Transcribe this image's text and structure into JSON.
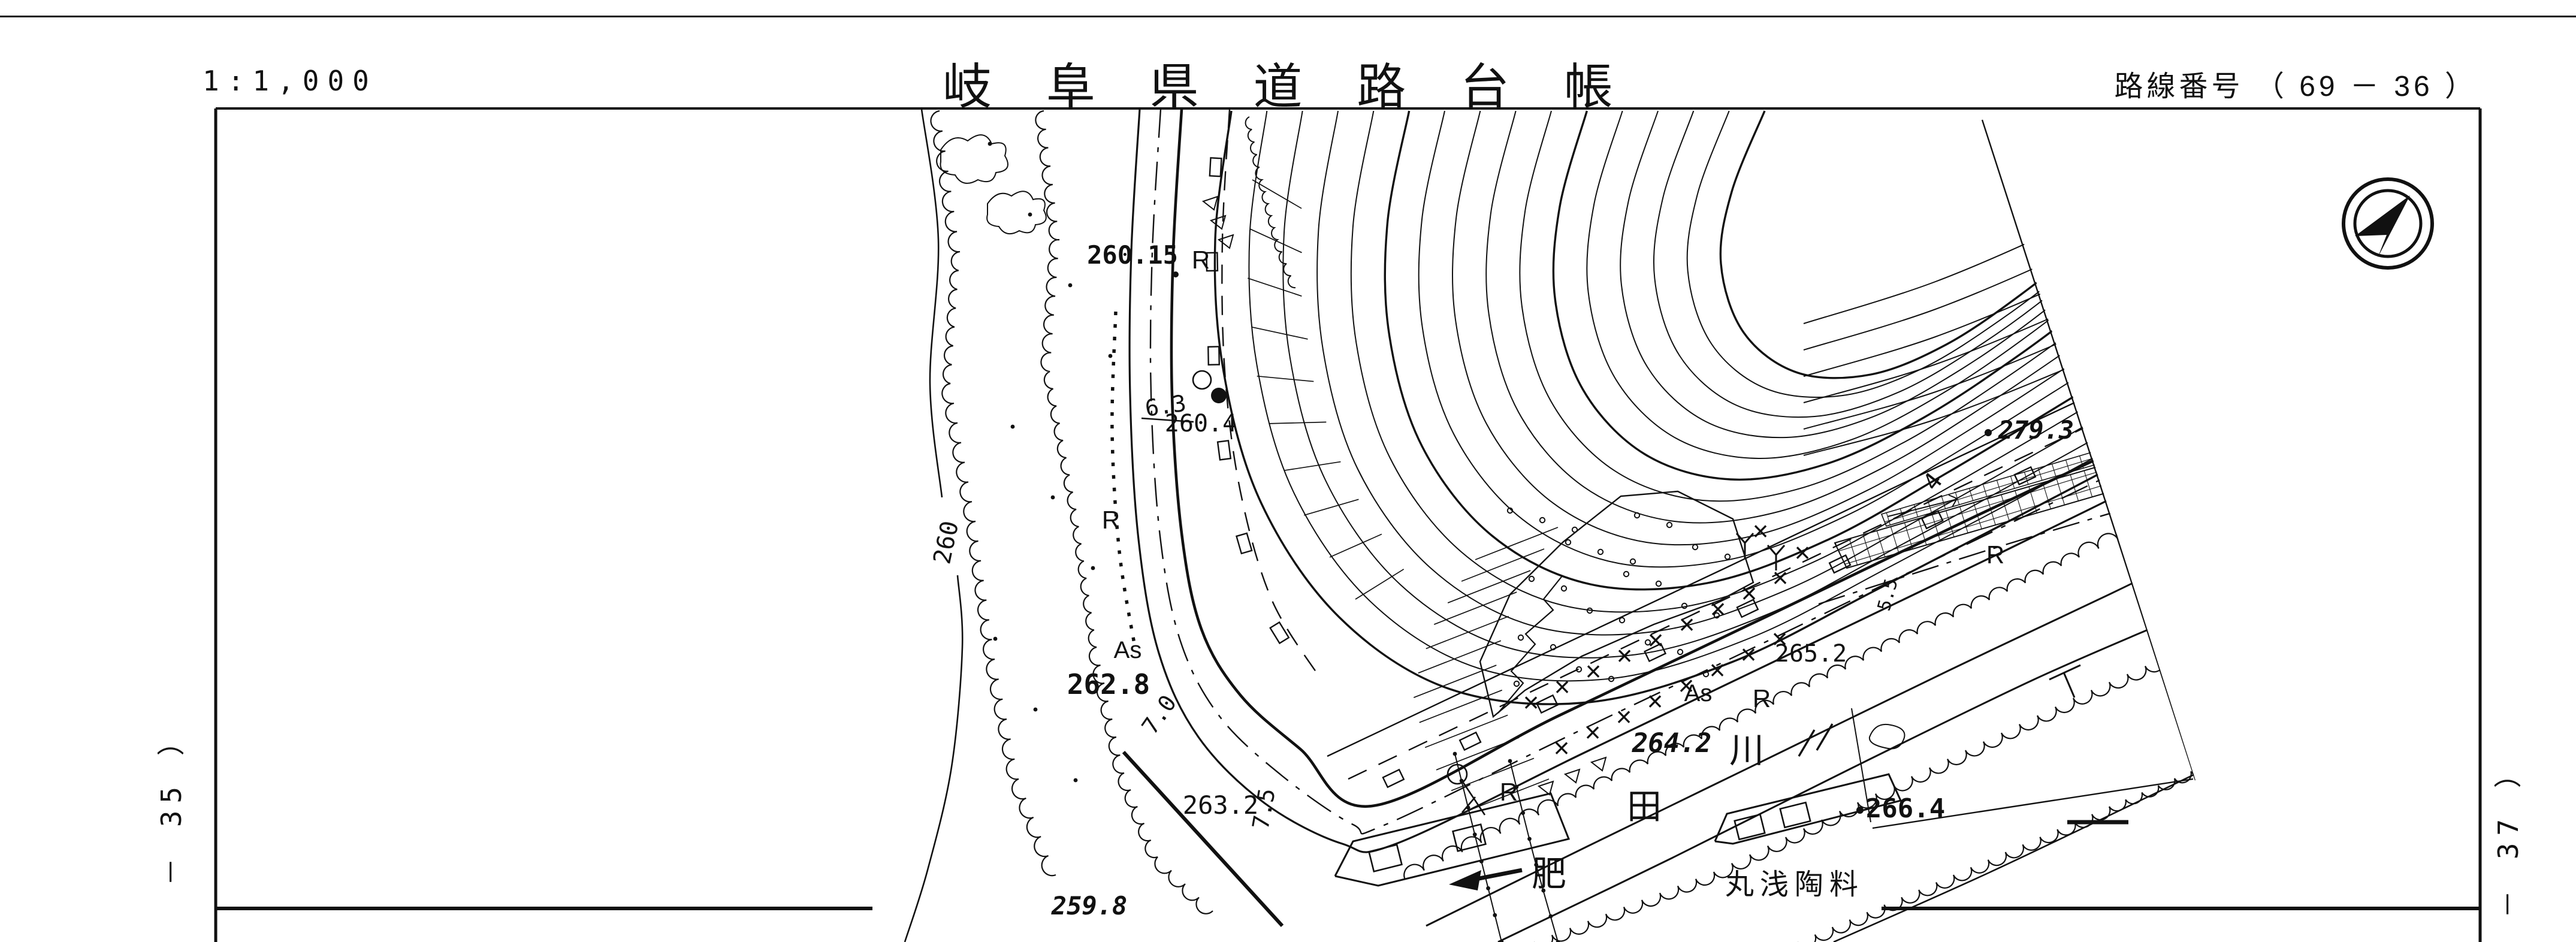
{
  "header": {
    "scale": "1:1,000",
    "title": "岐 阜 県 道 路 台 帳",
    "route": "路線番号 （ 69 － 36 ）"
  },
  "margins": {
    "left_sheet": "－ 35 ）",
    "right_sheet": "－ 37 ）"
  },
  "map": {
    "elevations": {
      "e26015": "260.15",
      "e2604": "260.4",
      "e2628": "262.8",
      "e2632": "263.2",
      "e2598": "259.8",
      "e260": "260",
      "e2642": "264.2",
      "e2652": "265.2",
      "e2664": "266.4",
      "e2793": "279.3"
    },
    "widths": {
      "w63": "6.3",
      "w70": "7.0",
      "w75": "7.5",
      "w55": "5.5",
      "w4": "4"
    },
    "surface_marks": {
      "r": "R",
      "as": "As"
    },
    "river_name": {
      "c1": "肥",
      "c2": "田",
      "c3": "川"
    },
    "company": "丸浅陶料",
    "icons": {
      "north_arrow": "north-arrow"
    }
  }
}
